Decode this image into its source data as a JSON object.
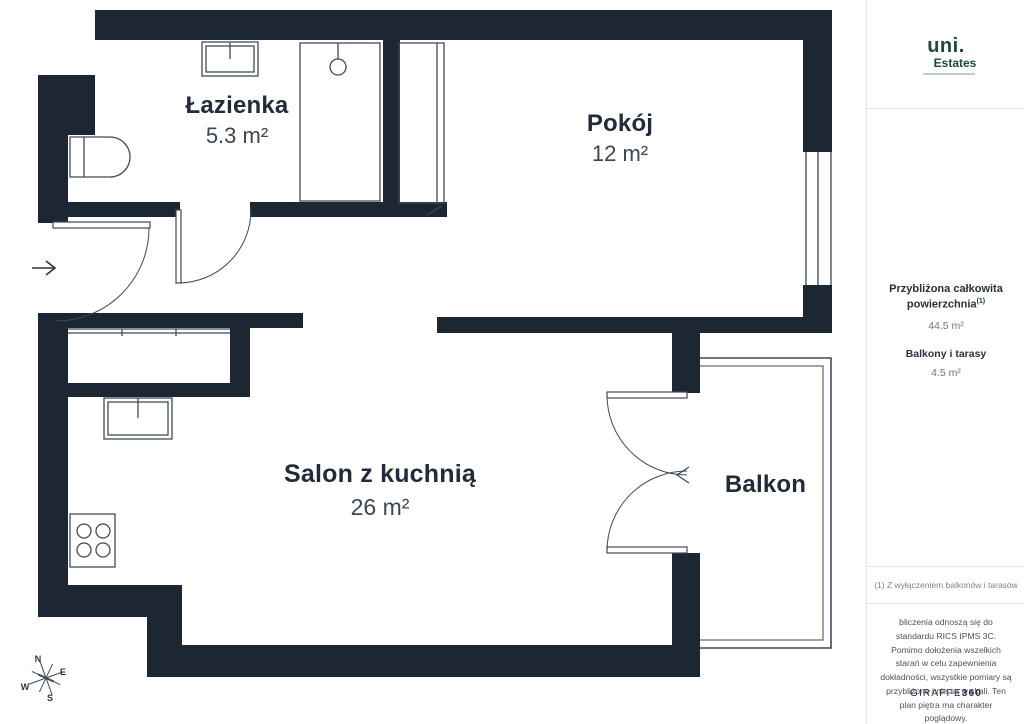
{
  "plan": {
    "rooms": [
      {
        "name": "Łazienka",
        "area": "5.3 m²"
      },
      {
        "name": "Pokój",
        "area": "12 m²"
      },
      {
        "name": "Salon z kuchnią",
        "area": "26 m²"
      },
      {
        "name": "Balkon",
        "area": ""
      }
    ],
    "compass": {
      "n": "N",
      "e": "E",
      "s": "S",
      "w": "W"
    }
  },
  "sidebar": {
    "logo": {
      "brand": "uni.",
      "sub": "Estates"
    },
    "summary": {
      "total_label": "Przybliżona całkowita powierzchnia",
      "total_sup": "(1)",
      "total_value": "44.5 m²",
      "balcony_label": "Balkony i tarasy",
      "balcony_value": "4.5 m²"
    },
    "footnote": "(1) Z wyłączeniem balkonów i tarasów",
    "disclaimer": "bliczenia odnoszą się do standardu RICS IPMS 3C. Pomimo dołożenia wszelkich starań w celu zapewnienia dokładności, wszystkie pomiary są przybliżone i nie są w skali. Ten plan piętra ma charakter poglądowy.",
    "brand_footer": {
      "name": "GIRAFFE",
      "suffix": "360"
    }
  },
  "colors": {
    "wall": "#1d2633",
    "thin_line": "#3f4a58",
    "text_dark": "#212b39",
    "text_gray": "#6d7682",
    "logo_green": "#1c4a36"
  }
}
